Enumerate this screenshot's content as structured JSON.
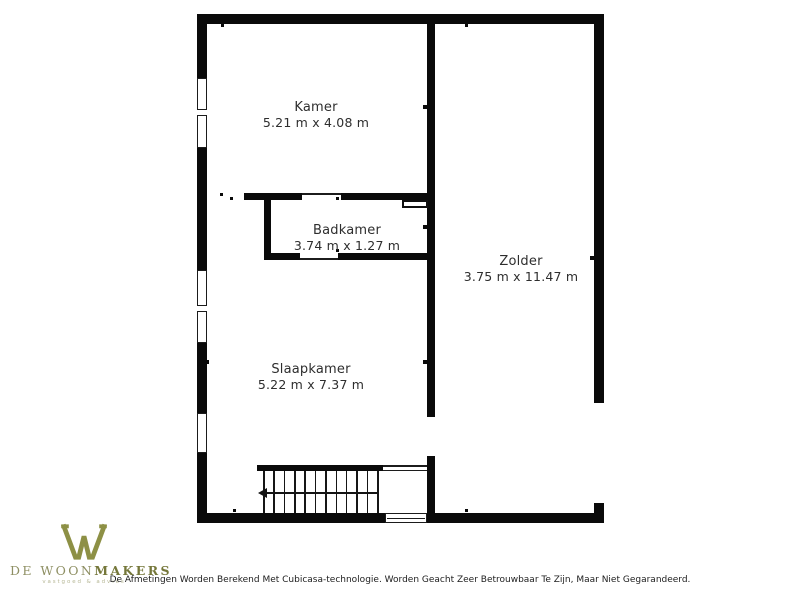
{
  "floorplan": {
    "wall_color": "#0a0a0a",
    "background": "#ffffff",
    "rooms": [
      {
        "id": "kamer",
        "name": "Kamer",
        "dimensions": "5.21 m x 4.08 m"
      },
      {
        "id": "badkamer",
        "name": "Badkamer",
        "dimensions": "3.74 m x 1.27 m"
      },
      {
        "id": "zolder",
        "name": "Zolder",
        "dimensions": "3.75 m x 11.47 m"
      },
      {
        "id": "slaapkamer",
        "name": "Slaapkamer",
        "dimensions": "5.22 m x 7.37 m"
      }
    ],
    "symbols": [
      "window-symbol",
      "door-symbol",
      "stairs-symbol",
      "stairs-direction-arrow"
    ]
  },
  "logo": {
    "icon": "w-monogram-icon",
    "icon_color": "#8d9045",
    "brand_prefix": "DE WOON",
    "brand_suffix": "MAKERS",
    "tagline": "vastgoed & advies",
    "prefix_color": "#8e8f63",
    "suffix_color": "#75773a",
    "tagline_color": "#b6b795"
  },
  "footer": {
    "disclaimer": "De Afmetingen Worden Berekend Met Cubicasa-technologie. Worden Geacht Zeer Betrouwbaar Te Zijn, Maar Niet Gegarandeerd."
  }
}
